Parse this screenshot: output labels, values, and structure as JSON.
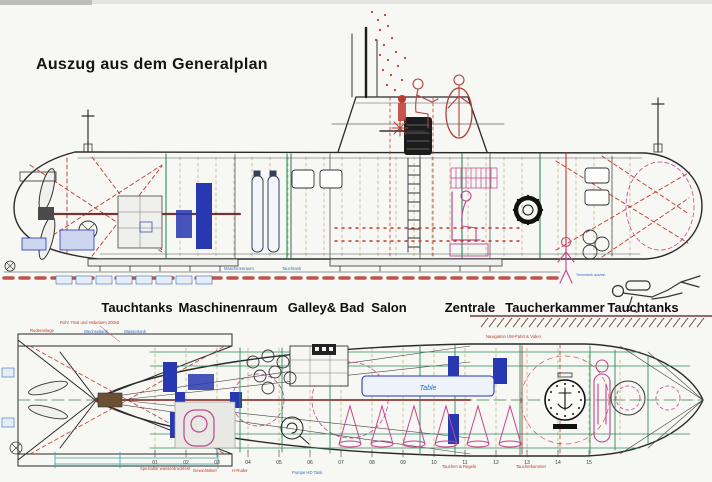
{
  "title": "Auszug aus dem Generalplan",
  "compartments": [
    "Tauchtanks",
    "Maschinenraum",
    "Galley& Bad",
    "Salon",
    "Zentrale",
    "Taucherkammer",
    "Tauchtanks"
  ],
  "side_view": {
    "keel_note_1": "Maschinenraum",
    "keel_note_2": "Tauchtank",
    "diver_note": "Trimmtank aus/ein"
  },
  "plan_view": {
    "table_label": "Table",
    "note_ruderanlage": "Ruderanlage",
    "note_rohr": "Rohr 70x6 und Hebelarm 200x8",
    "note_wechseltank": "Wechseltank",
    "note_wassertank": "Wassertank",
    "note_navigation": "Navigation UW-Fahrt & Video",
    "note_spezialtuer": "Spezialtür wasserdruckfest",
    "note_gewichtskiel": "Gewichtskiel",
    "note_hruder": "H-Ruder",
    "note_pumpe": "Pumpe HD Tank",
    "note_tauchen": "Tauchen & Regeln",
    "note_taucherkammer": "Taucherkammer",
    "frame_numbers": [
      "01",
      "02",
      "03",
      "04",
      "05",
      "06",
      "07",
      "08",
      "09",
      "10",
      "11",
      "12",
      "13",
      "14",
      "15"
    ]
  },
  "colors": {
    "paper": "#f7f7f4",
    "line_black": "#2a2a2a",
    "accent_red": "#c03a2e",
    "accent_magenta": "#c2458a",
    "accent_blue": "#2838b0",
    "accent_green": "#2e8a5a",
    "ground_maroon": "#7a3a34"
  }
}
